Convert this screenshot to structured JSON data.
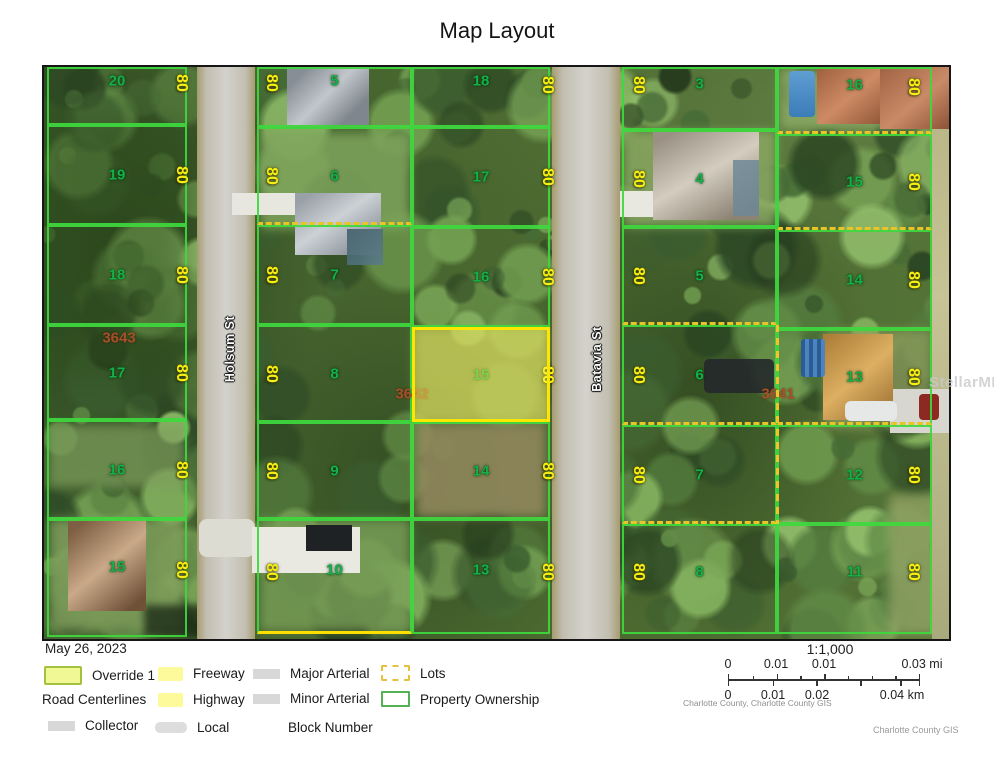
{
  "page": {
    "title": "Map Layout",
    "date": "May 26, 2023",
    "watermark": "StellarMLS"
  },
  "map": {
    "dimension_text": "80",
    "streets": [
      {
        "name": "Holsum St",
        "x": 186,
        "y": 282
      },
      {
        "name": "Batavia St",
        "x": 553,
        "y": 292
      }
    ],
    "block_numbers": [
      {
        "label": "3643",
        "x": 75,
        "y": 271
      },
      {
        "label": "3642",
        "x": 368,
        "y": 327
      },
      {
        "label": "3641",
        "x": 734,
        "y": 327
      }
    ],
    "columns": [
      {
        "id": "A",
        "x": 3,
        "w": 140,
        "dim_x": 137,
        "parcels": [
          {
            "n": "20",
            "y": 0,
            "h": 58,
            "ly": 14,
            "dy": 16
          },
          {
            "n": "19",
            "y": 58,
            "h": 100
          },
          {
            "n": "18",
            "y": 158,
            "h": 100
          },
          {
            "n": "17",
            "y": 258,
            "h": 95
          },
          {
            "n": "16",
            "y": 353,
            "h": 99
          },
          {
            "n": "15",
            "y": 452,
            "h": 118,
            "ly": 48,
            "dy": 51
          }
        ]
      },
      {
        "id": "B",
        "x": 213,
        "w": 155,
        "dim_x": 227,
        "parcels": [
          {
            "n": "5",
            "y": 0,
            "h": 60,
            "ly": 14,
            "dy": 16
          },
          {
            "n": "6",
            "y": 60,
            "h": 98,
            "dashed_bottom": true
          },
          {
            "n": "7",
            "y": 158,
            "h": 100
          },
          {
            "n": "8",
            "y": 258,
            "h": 97
          },
          {
            "n": "9",
            "y": 355,
            "h": 97
          },
          {
            "n": "10",
            "y": 452,
            "h": 115,
            "yellow_bottom": true,
            "ly": 51,
            "dy": 53
          }
        ]
      },
      {
        "id": "C",
        "x": 368,
        "w": 138,
        "dim_x": 503,
        "parcels": [
          {
            "n": "18",
            "y": 0,
            "h": 60,
            "ly": 14,
            "dy": 18
          },
          {
            "n": "17",
            "y": 60,
            "h": 100
          },
          {
            "n": "16",
            "y": 160,
            "h": 100
          },
          {
            "n": "15",
            "y": 260,
            "h": 95,
            "highlight": true
          },
          {
            "n": "14",
            "y": 355,
            "h": 97
          },
          {
            "n": "13",
            "y": 452,
            "h": 115,
            "ly": 51,
            "dy": 53
          }
        ]
      },
      {
        "id": "D",
        "x": 578,
        "w": 155,
        "dim_x": 594,
        "parcels": [
          {
            "n": "3",
            "y": 0,
            "h": 63,
            "ly": 17,
            "dy": 18
          },
          {
            "n": "4",
            "y": 63,
            "h": 97
          },
          {
            "n": "5",
            "y": 160,
            "h": 98,
            "dashed_bottom": true
          },
          {
            "n": "6",
            "y": 258,
            "h": 100,
            "dashed_bottom": true
          },
          {
            "n": "7",
            "y": 358,
            "h": 99,
            "dashed_bottom": true
          },
          {
            "n": "8",
            "y": 457,
            "h": 110,
            "ly": 48,
            "dy": 48
          }
        ]
      },
      {
        "id": "E",
        "x": 733,
        "w": 155,
        "dim_x": 869,
        "parcels": [
          {
            "n": "16",
            "y": 0,
            "h": 67,
            "dashed_bottom": true,
            "ly": 18,
            "dy": 20
          },
          {
            "n": "15",
            "y": 67,
            "h": 96,
            "dashed_bottom": true
          },
          {
            "n": "14",
            "y": 163,
            "h": 99
          },
          {
            "n": "13",
            "y": 262,
            "h": 96,
            "dashed_bottom": true
          },
          {
            "n": "12",
            "y": 358,
            "h": 99
          },
          {
            "n": "11",
            "y": 457,
            "h": 110,
            "ly": 48,
            "dy": 48
          }
        ]
      }
    ],
    "lot_lines": [
      {
        "x": 732,
        "y": 258,
        "w": 3,
        "h": 199
      }
    ],
    "colors": {
      "parcel_line": "#3ed93e",
      "highlight_fill": "#fff85a",
      "highlight_line": "#ffe600",
      "lot_dash": "#e9c428",
      "number_green": "#14b04a",
      "dimension_yellow": "#f7ee12",
      "block_brown": "#a4512a"
    }
  },
  "legend": {
    "override": "Override 1",
    "road_centerlines": "Road Centerlines",
    "collector": "Collector",
    "freeway": "Freeway",
    "highway": "Highway",
    "local": "Local",
    "major_arterial": "Major Arterial",
    "minor_arterial": "Minor Arterial",
    "block_number": "Block Number",
    "lots": "Lots",
    "property_ownership": "Property Ownership"
  },
  "scale": {
    "ratio": "1:1,000",
    "mi": [
      "0",
      "0.01",
      "0.01",
      "0.03 mi"
    ],
    "km": [
      "0",
      "0.01",
      "0.02",
      "0.04 km"
    ],
    "attribution": "Charlotte County, Charlotte County GIS"
  },
  "credit": "Charlotte County GIS"
}
